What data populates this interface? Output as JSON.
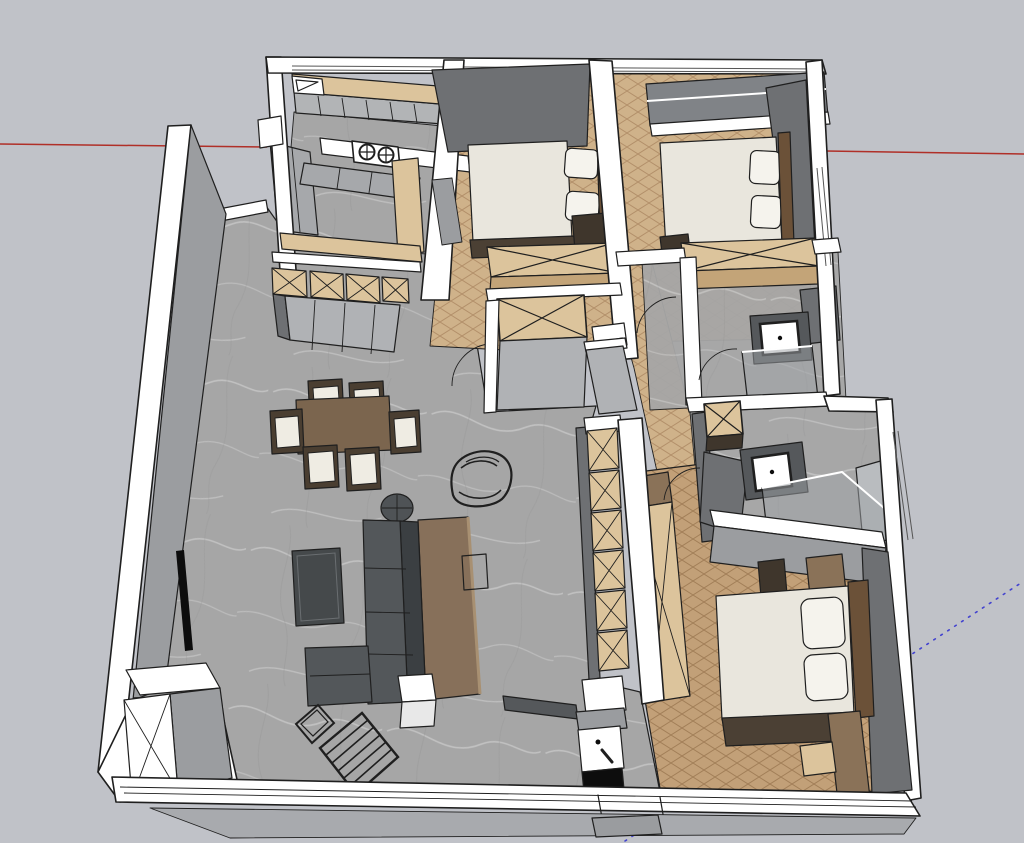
{
  "canvas": {
    "width": 1024,
    "height": 843
  },
  "colors": {
    "background": "#c0c2c8",
    "outline": "#1f1f1f",
    "wallWhite": "#ffffff",
    "wallGrayLight": "#b0b2b5",
    "wallGrayMid": "#9b9da0",
    "wallGrayDark": "#6e7073",
    "outerStrip": "#a8aaae",
    "floorBase": "#a6a6a6",
    "floorVein": "#d6d6d6",
    "floorVeinDark": "#8f8f8f",
    "herrABase": "#cfb28a",
    "herrAStroke": "#b3906a",
    "herrBBase": "#c2a078",
    "herrBStroke": "#a27f58",
    "wood": "#dcc49c",
    "woodFront": "#c3a478",
    "woodDark": "#8a7258",
    "counterGray": "#b2b4b6",
    "cabinetGray": "#a6a8ab",
    "mattress": "#e9e6dd",
    "pillow": "#f5f3ed",
    "headboard": "#6b5138",
    "bedFrameDark": "#4b4034",
    "bedBoxDark": "#3f362c",
    "sofaSeat": "#53575a",
    "sofaBack": "#3b3f42",
    "consoleBrown": "#87705a",
    "consoleEdge": "#a89072",
    "diningTable": "#7b654e",
    "chairFrame": "#4a3e31",
    "cushion": "#efece3",
    "coffeeTable": "#45494b",
    "roundTable": "#4f5356",
    "benchGray": "#55585b",
    "glass": "#9fa3a6",
    "glassInner": "#b9bcbf",
    "black": "#0d0d0d",
    "stepGray": "#9a9c9f",
    "redAxis": "#b02f28",
    "blueAxis": "#4343cf",
    "windowFrame": "#555555",
    "windowGlassDark": "#808387"
  },
  "axes": {
    "red": {
      "name": "red-axis",
      "style": "solid"
    },
    "blue": {
      "name": "blue-axis",
      "style": "dotted"
    }
  },
  "scene": {
    "description": "3D overhead view of an apartment floor plan in a modeling viewport",
    "rooms": [
      {
        "name": "kitchen",
        "furniture": [
          "upper-cabinets",
          "sink",
          "two-burner-cooktop",
          "base-cabinets",
          "counter-return"
        ]
      },
      {
        "name": "living-dining",
        "furniture": [
          "dining-table",
          "dining-chairs",
          "armchair",
          "round-side-table",
          "sofa",
          "chaise",
          "console-table",
          "coffee-table",
          "wall-tv",
          "lounge-chair",
          "magazine-rack",
          "shoe-cabinet",
          "cube-side-table"
        ]
      },
      {
        "name": "bedroom-1",
        "furniture": [
          "double-bed",
          "pillows",
          "wardrobe"
        ]
      },
      {
        "name": "bedroom-2",
        "furniture": [
          "double-bed",
          "pillows",
          "wardrobe"
        ]
      },
      {
        "name": "bathroom-1",
        "furniture": [
          "washbasin",
          "glass-shower",
          "vanity-counter"
        ]
      },
      {
        "name": "bathroom-2",
        "furniture": [
          "washbasin",
          "glass-shower",
          "storage-cube"
        ]
      },
      {
        "name": "master-bedroom",
        "furniture": [
          "double-bed",
          "pillows",
          "wardrobe",
          "nightstands",
          "bench",
          "stool"
        ]
      },
      {
        "name": "hallway",
        "furniture": [
          "closet",
          "storage-column"
        ]
      },
      {
        "name": "entry",
        "furniture": [
          "wash-stand",
          "bench",
          "entry-step"
        ]
      }
    ],
    "counts": {
      "cooktop_burners": 2,
      "dining_chairs": 6,
      "sideboard_crates": 4,
      "storage_column_cells": 6,
      "beds": 3,
      "bathrooms": 2
    }
  }
}
